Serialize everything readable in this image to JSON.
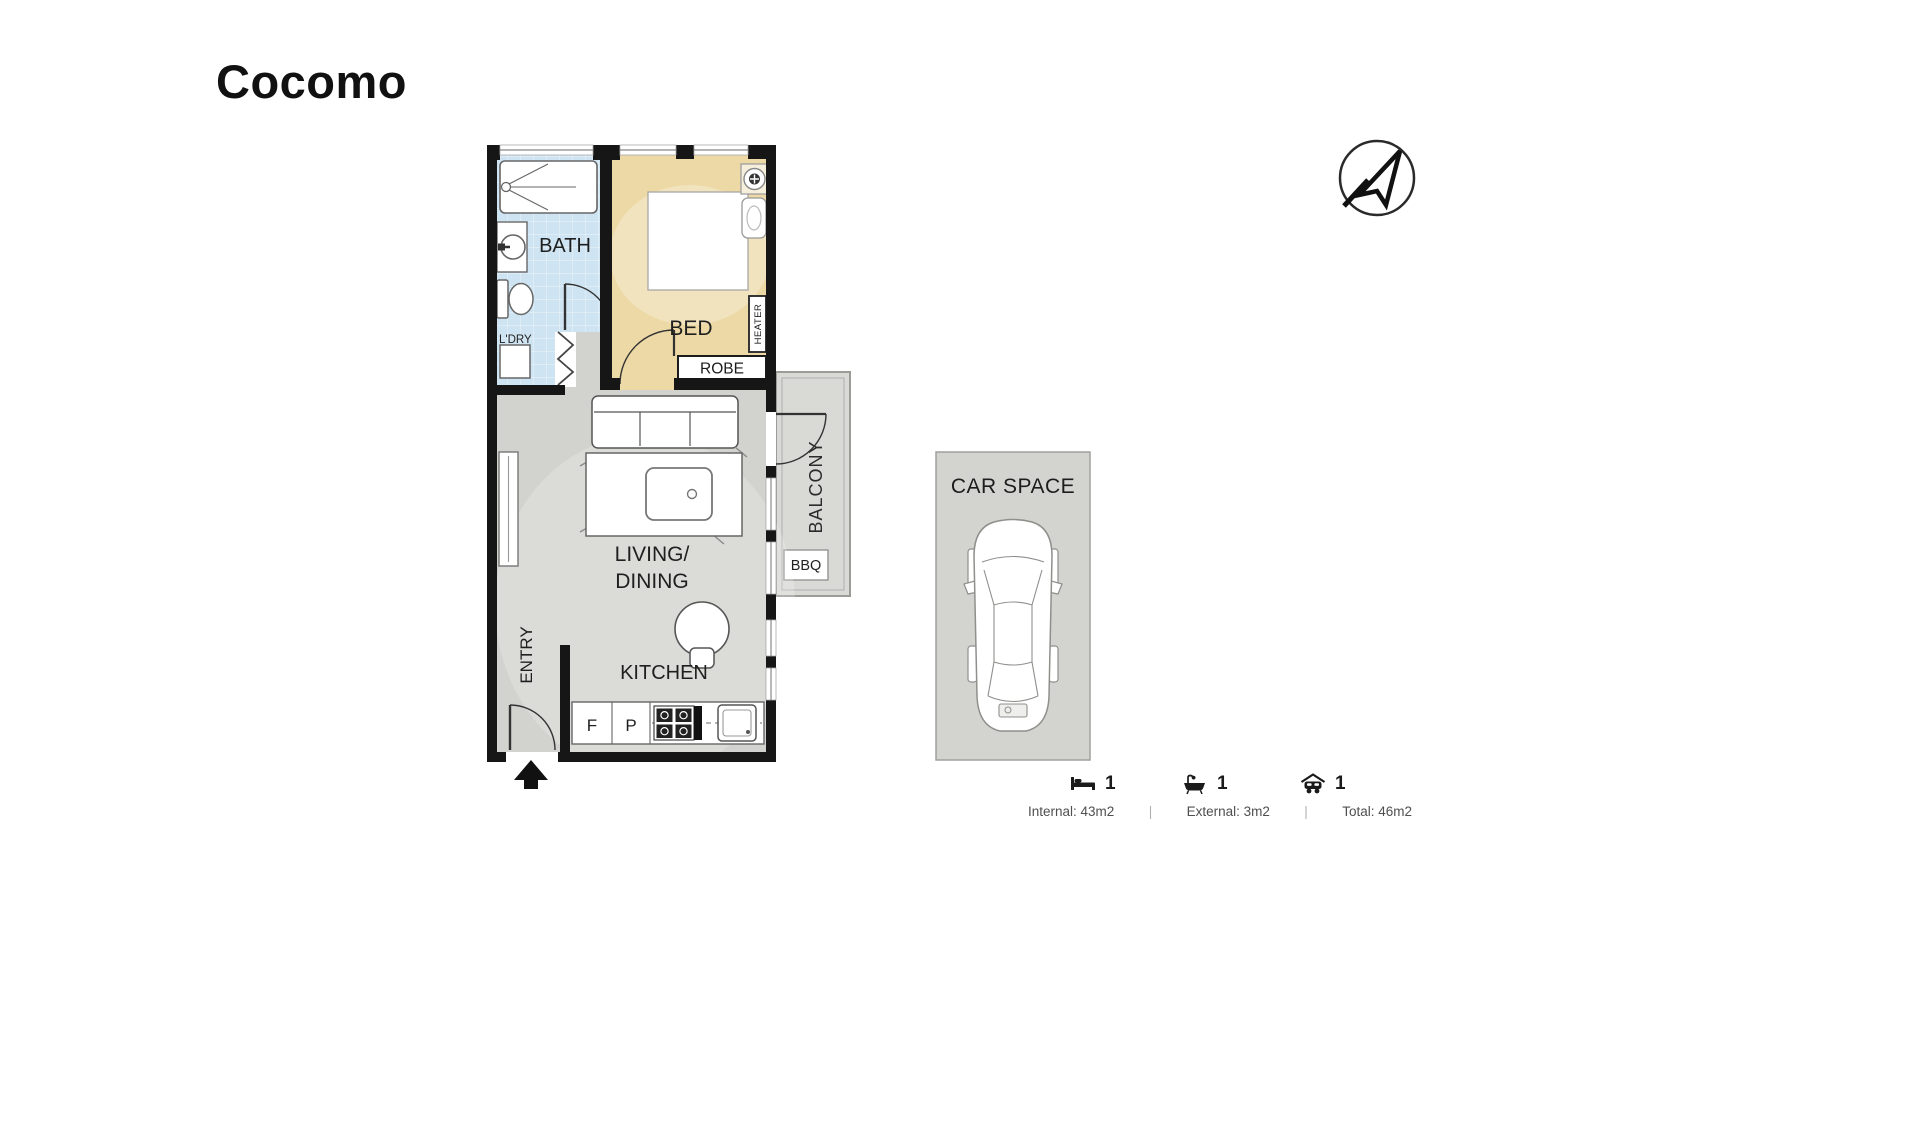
{
  "title": "Cocomo",
  "plan": {
    "bath": {
      "label": "BATH"
    },
    "laundry": {
      "label": "L'DRY"
    },
    "bedroom": {
      "label": "BED",
      "robe": "ROBE",
      "heater": "HEATER"
    },
    "living": {
      "line1": "LIVING/",
      "line2": "DINING"
    },
    "kitchen": {
      "label": "KITCHEN",
      "fridge": "F",
      "pantry": "P"
    },
    "entry": {
      "label": "ENTRY"
    },
    "balcony": {
      "label": "BALCONY",
      "bbq": "BBQ"
    },
    "car_space": {
      "label": "CAR SPACE"
    }
  },
  "legend": {
    "beds": "1",
    "baths": "1",
    "cars": "1",
    "internal": "Internal: 43m2",
    "external": "External: 3m2",
    "total": "Total: 46m2",
    "divider": "|"
  },
  "colors": {
    "wall": "#161616",
    "bath_floor": "#cfe4f2",
    "bed_floor": "#ecd9a6",
    "living_floor": "#d2d2cf",
    "balcony_floor": "#d9d9d6",
    "car_space_fill": "#d3d3d0"
  }
}
